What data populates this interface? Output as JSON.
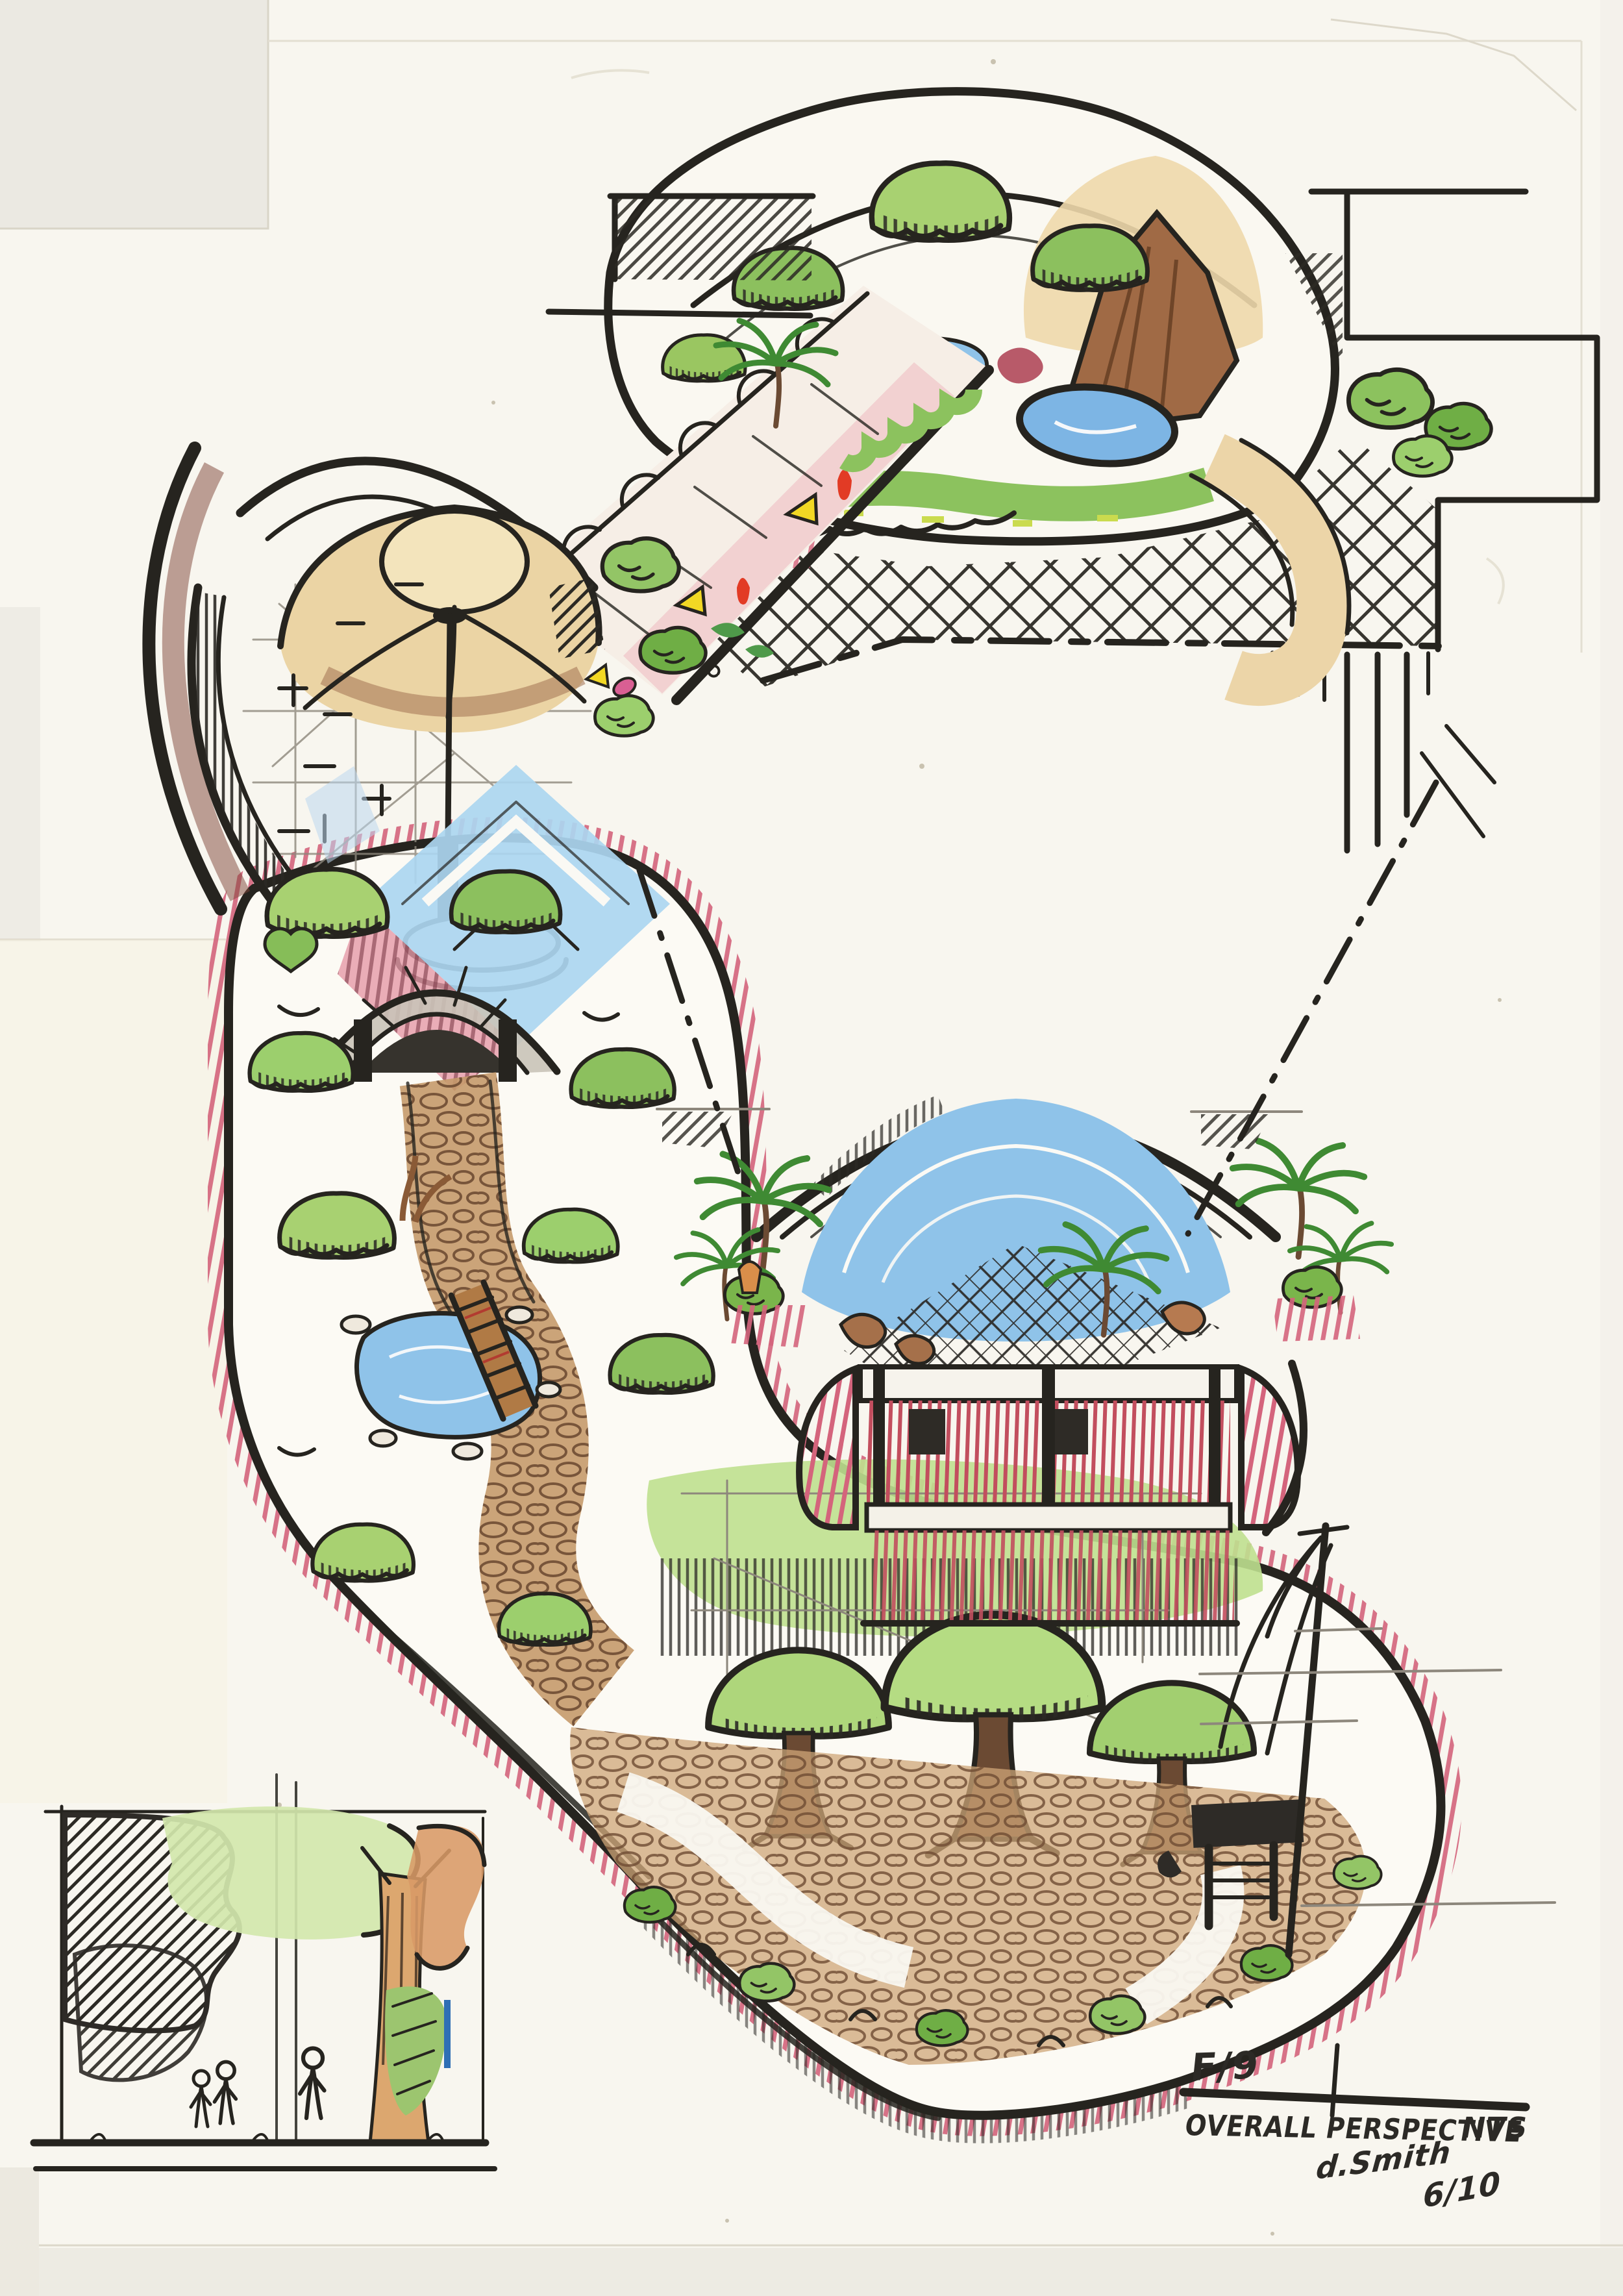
{
  "title_block": {
    "sheet_number": "F/9",
    "drawing_title": "OVERALL PERSPECTIVE",
    "scale_label": "NTS",
    "signature": "d.Smith",
    "date": "6/10"
  },
  "palette": {
    "paper": "#f8f6ef",
    "ink": "#26241f",
    "foliage_light": "#a8d171",
    "foliage_dark": "#5f9e3e",
    "water_blue": "#8fc3e9",
    "path_brown": "#c59a6b",
    "wall_pink": "#d4647c",
    "building_red": "#c24e5e",
    "roof_tan": "#ecd5a8",
    "trunk_orange": "#d49a6a"
  }
}
